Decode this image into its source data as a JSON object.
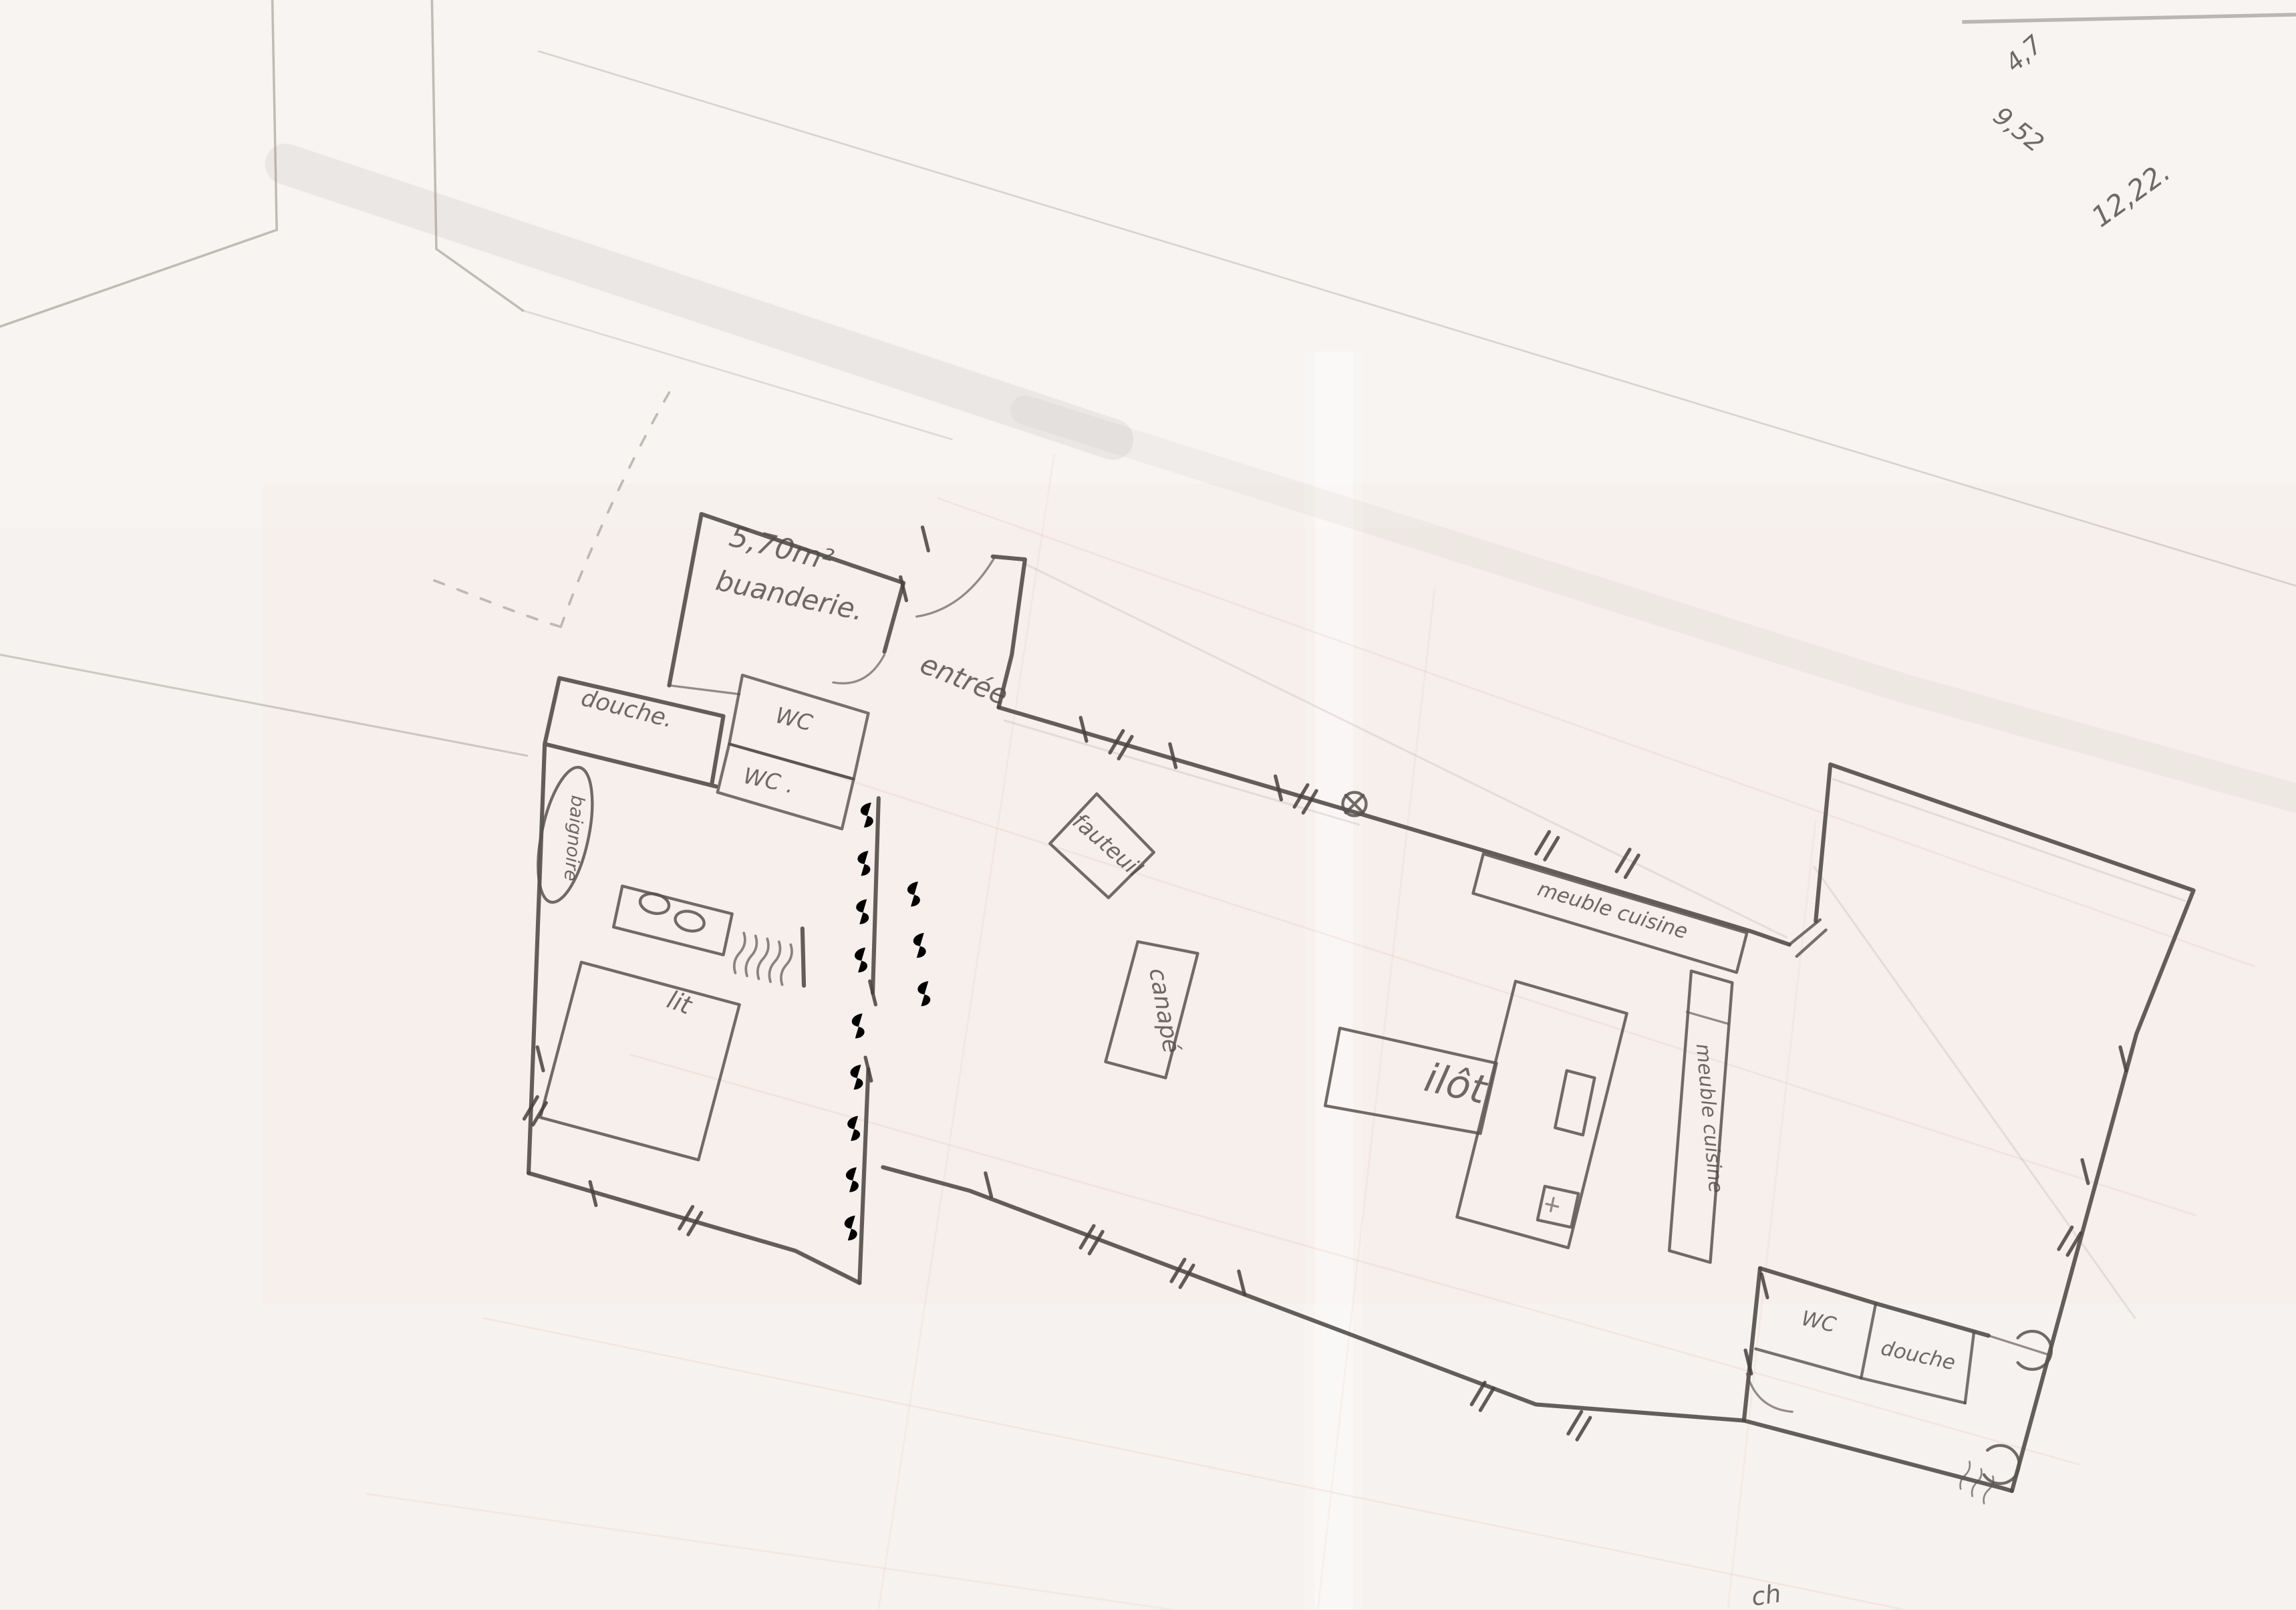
{
  "plan": {
    "rooms": {
      "buanderie_area": "5,70m²",
      "buanderie": "buanderie.",
      "entree": "entrée",
      "wc_upper": "WC",
      "wc_lower": "WC .",
      "douche": "douche.",
      "wc_2": "WC",
      "douche_2": "douche"
    },
    "fixtures": {
      "baignoire": "baignoire",
      "lit": "lit",
      "fauteuil": "fauteuil",
      "canape": "canapé",
      "ilot": "ilôt",
      "meuble_cuisine_haut": "meuble cuisine",
      "meuble_cuisine_droit": "meuble cuisine"
    },
    "measurements": {
      "dim_1": "4,7",
      "dim_2": "9,52",
      "dim_3": "12,22.",
      "edge_note": "ch"
    },
    "colors": {
      "paper": "#f6f2ef",
      "pencil": "#4d4947",
      "pencil_light": "#9a948e",
      "ghost_pink": "#d98f7a"
    }
  }
}
